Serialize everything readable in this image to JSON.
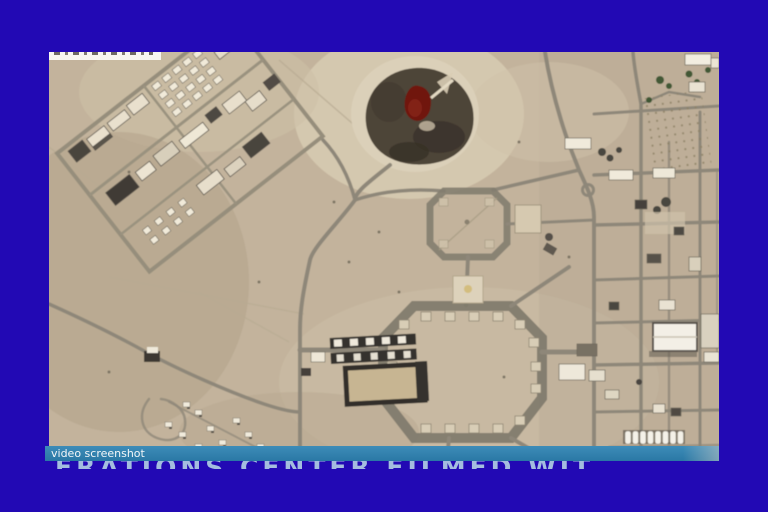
{
  "window": {
    "background_color": "#2209b4"
  },
  "photo": {
    "type": "satellite-aerial-view",
    "subject": "desert military base with road grid, two octagonal road loops, diagonal building compound and dark circular grove with red pond",
    "colors": {
      "sand": "#c3b39c",
      "sand_light": "#d7cbb3",
      "road": "#8e8779",
      "grove": "#4e4437",
      "grove_red": "#6f150f",
      "building_light": "#efe8d6",
      "building_dark": "#3f3b35"
    },
    "top_label_strip_color": "#f7f6f1"
  },
  "caption_bar": {
    "label": "video screenshot",
    "background_color": "#2e7fad",
    "text_color": "#f2f6f8"
  },
  "headline": {
    "text": "ERATIONS CENTER FILMED WIT",
    "color": "#a4bddf",
    "clipped": "only letter tops visible"
  }
}
